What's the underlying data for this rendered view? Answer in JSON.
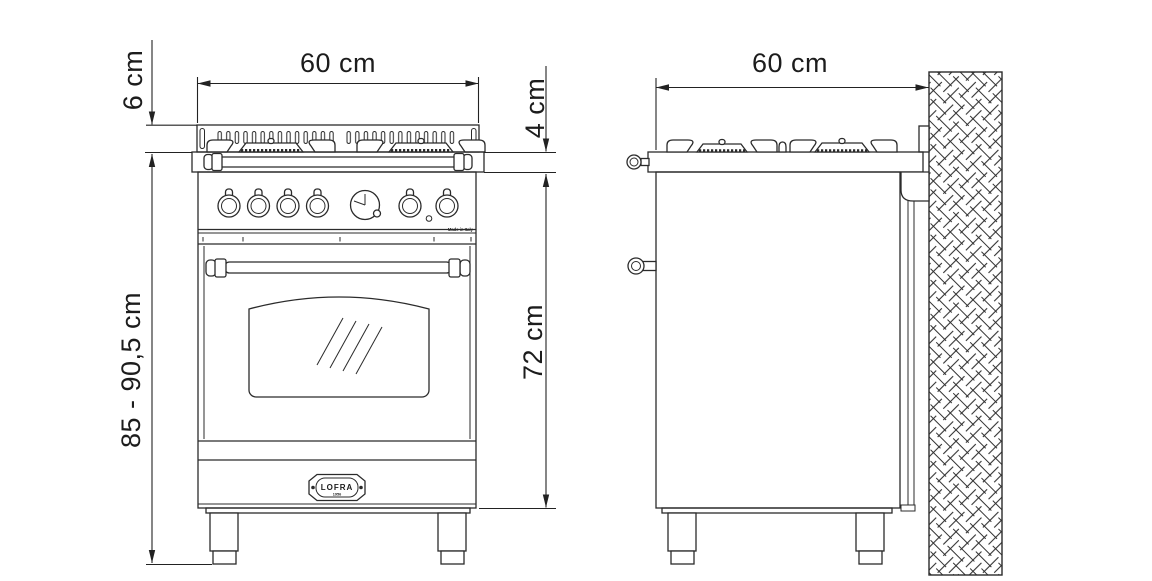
{
  "colors": {
    "ink": "#2b2b2b",
    "paper": "#ffffff"
  },
  "front_view": {
    "dim_backsplash_height": "6 cm",
    "dim_width": "60 cm",
    "dim_worktop_edge_height": "4 cm",
    "dim_overall_height_range": "85 - 90,5 cm",
    "dim_body_height": "72 cm",
    "panel_text_made_in": "Made in Italy",
    "badge_brand": "LOFRA",
    "badge_year": "1956"
  },
  "side_view": {
    "dim_depth": "60 cm"
  }
}
